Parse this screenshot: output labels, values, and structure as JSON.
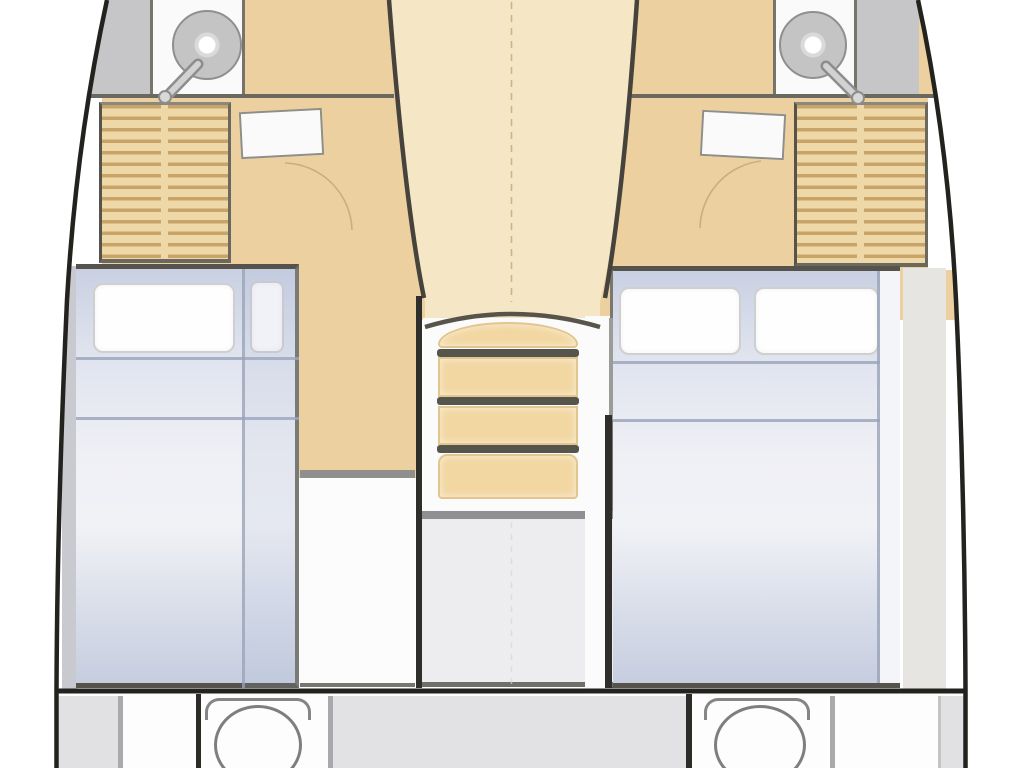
{
  "page": {
    "title": "Catamaran lower-deck floor plan",
    "type": "boat interior layout diagram",
    "orientation": "bow at top, transom at bottom"
  },
  "colors": {
    "hull-line": "#23221f",
    "wall-dark": "#6b695f",
    "floor-cabin": "#ecd0a0",
    "floor-corridor": "#f5e6c5",
    "slat-bg": "#eed8a8",
    "counter": "#fafafa",
    "gray-panel": "#c6c6c8",
    "side-band": "#e6e5e1",
    "mattress-top": "#c9d0e2",
    "mattress-mid": "#eff0f5",
    "mattress-bottom": "#c6cddf",
    "pillow": "#fefefe",
    "seam": "#9aa2b8",
    "tread": "#f2d7a2",
    "riser": "#56554b",
    "room-gray": "#ededef",
    "room-white": "#fcfcfc",
    "transom-gray": "#e1e1e3",
    "sink": "#c4c4c4"
  },
  "regions": {
    "hull_port": "Port hull outline",
    "hull_starboard": "Starboard hull outline",
    "sink_port": "Port washbasin with mixer tap",
    "sink_starboard": "Starboard washbasin with mixer tap",
    "counter_port": "Port vanity counter",
    "counter_starboard": "Starboard vanity counter",
    "shower_port": "Port shower panel",
    "shower_starboard": "Starboard shower panel",
    "wardrobe_port": "Port louvered wardrobe",
    "wardrobe_starboard": "Starboard louvered wardrobe",
    "shelf_port": "Port cabin shelf",
    "shelf_starboard": "Starboard cabin shelf",
    "cabin_floor": "Cabin and corridor wood flooring",
    "companionway": "Central companionway steps",
    "under_stair_room": "Compartment under companionway",
    "room_port_aft": "Port aft compartment",
    "berth_port": "Port double berth with pillows",
    "berth_starboard": "Starboard double berth with two pillows",
    "wc_port": "Port WC",
    "wc_starboard": "Starboard WC",
    "transom": "Transom and aft platform",
    "centerline": "Boat centerline (dashed)",
    "door_arc_port": "Port cabin door swing",
    "door_arc_starboard": "Starboard cabin door swing"
  }
}
